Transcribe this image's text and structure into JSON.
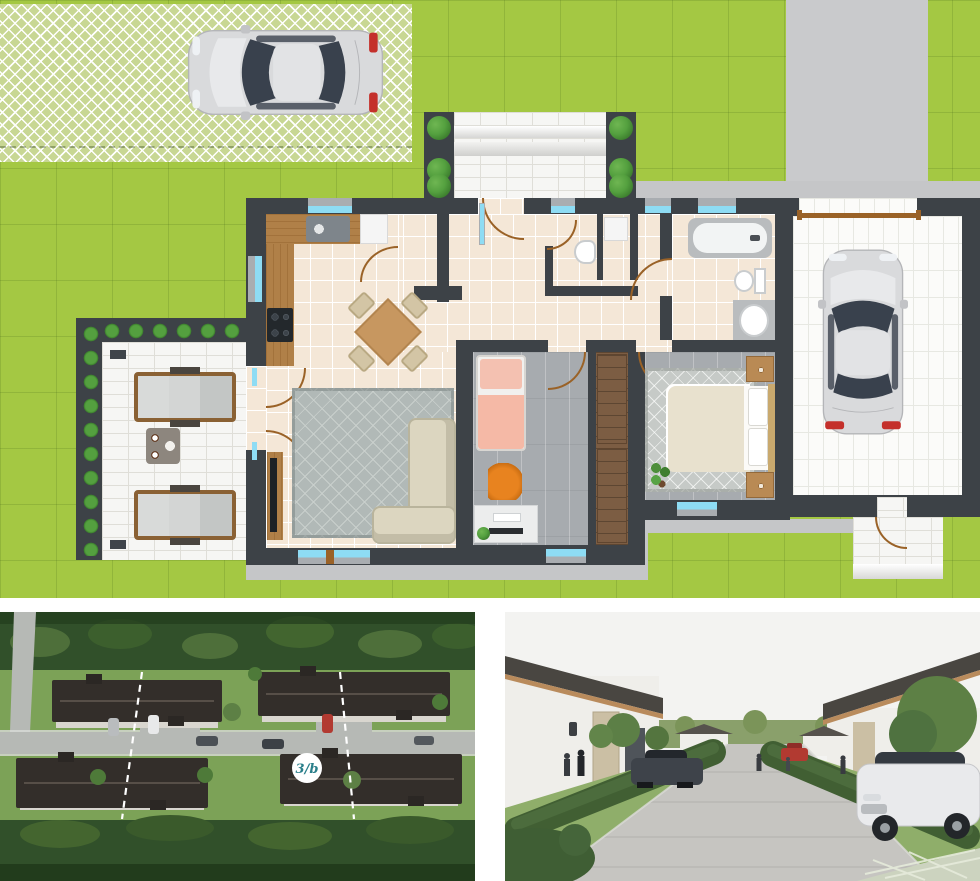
{
  "colors": {
    "lawn": "#a4c843",
    "paver": "#c8d794",
    "paverline": "#ffffff",
    "drive": "#c9cacc",
    "walk": "#c5c6c8",
    "wall": "#3d4247",
    "tile": "#f4e7d7",
    "grout": "#ffffff",
    "wood": "#b08048",
    "wood2": "#8a6134",
    "grayfloor": "#a7abaf",
    "closet": "#7c5d43",
    "terracepav": "#f6f6f4",
    "terraceline": "#dfded8",
    "garagepav": "#fbfbf9",
    "garageline": "#e7e8e2",
    "hedge": "#54a03f",
    "hedge2": "#3a7a2c",
    "win": "#8edcf4",
    "winframe": "#a9adb1",
    "door": "#9a6227",
    "sofa": "#dcd6c0",
    "sofaedge": "#b9b49c",
    "rug": "#b1b9b7",
    "rugline": "#c9cfcc",
    "mbed": "#e8e1ce",
    "mbedrug": "#c6cac7",
    "pink": "#f5b9a6",
    "orange": "#e8831f",
    "tvdark": "#1d2125",
    "fixt": "#b9bcbe",
    "washer": "#f5f5f5",
    "aforest": "#31502a",
    "aforest2": "#223c1c",
    "alawn": "#7ca257",
    "aroad": "#b6b9b5",
    "aroof": "#332e2a",
    "awall": "#d9d6cf",
    "badgefg": "#2a7f8a",
    "ssky": "#f3f3f1",
    "sroad": "#c6c5c1",
    "sgrass": "#8fae6a",
    "shedge": "#415f33",
    "sroof": "#494641",
    "swall": "#efeeea",
    "sstone": "#cbbfa4",
    "stree": "#5d8045",
    "scar": "#3e434a",
    "scarwhite": "#e9eaec",
    "scarred": "#b23a31"
  },
  "site_plan": {
    "areas": [
      "garden-lawn",
      "grass-paver-parking",
      "driveway",
      "sidewalk",
      "entrance-porch",
      "terrace",
      "kitchen-dining",
      "living-room",
      "hallway",
      "wc",
      "utility-niche",
      "bathroom",
      "child-bedroom",
      "wardrobe-corridor",
      "master-bedroom",
      "garage",
      "garden-path"
    ],
    "furniture": [
      "parked-car",
      "kitchen-counter",
      "sink",
      "cooktop",
      "fridge",
      "dining-table-4-chairs",
      "corner-sofa",
      "tv-cabinet",
      "area-rug",
      "single-bed",
      "desk",
      "desk-chair",
      "wardrobes",
      "double-bed",
      "nightstands",
      "potted-plants",
      "bathtub",
      "toilet",
      "washbasin",
      "washing-machine",
      "garage-car",
      "sun-loungers",
      "coffee-table",
      "hedges"
    ]
  },
  "photos": {
    "aerial": {
      "lot_label": "3/b"
    },
    "street": {}
  }
}
